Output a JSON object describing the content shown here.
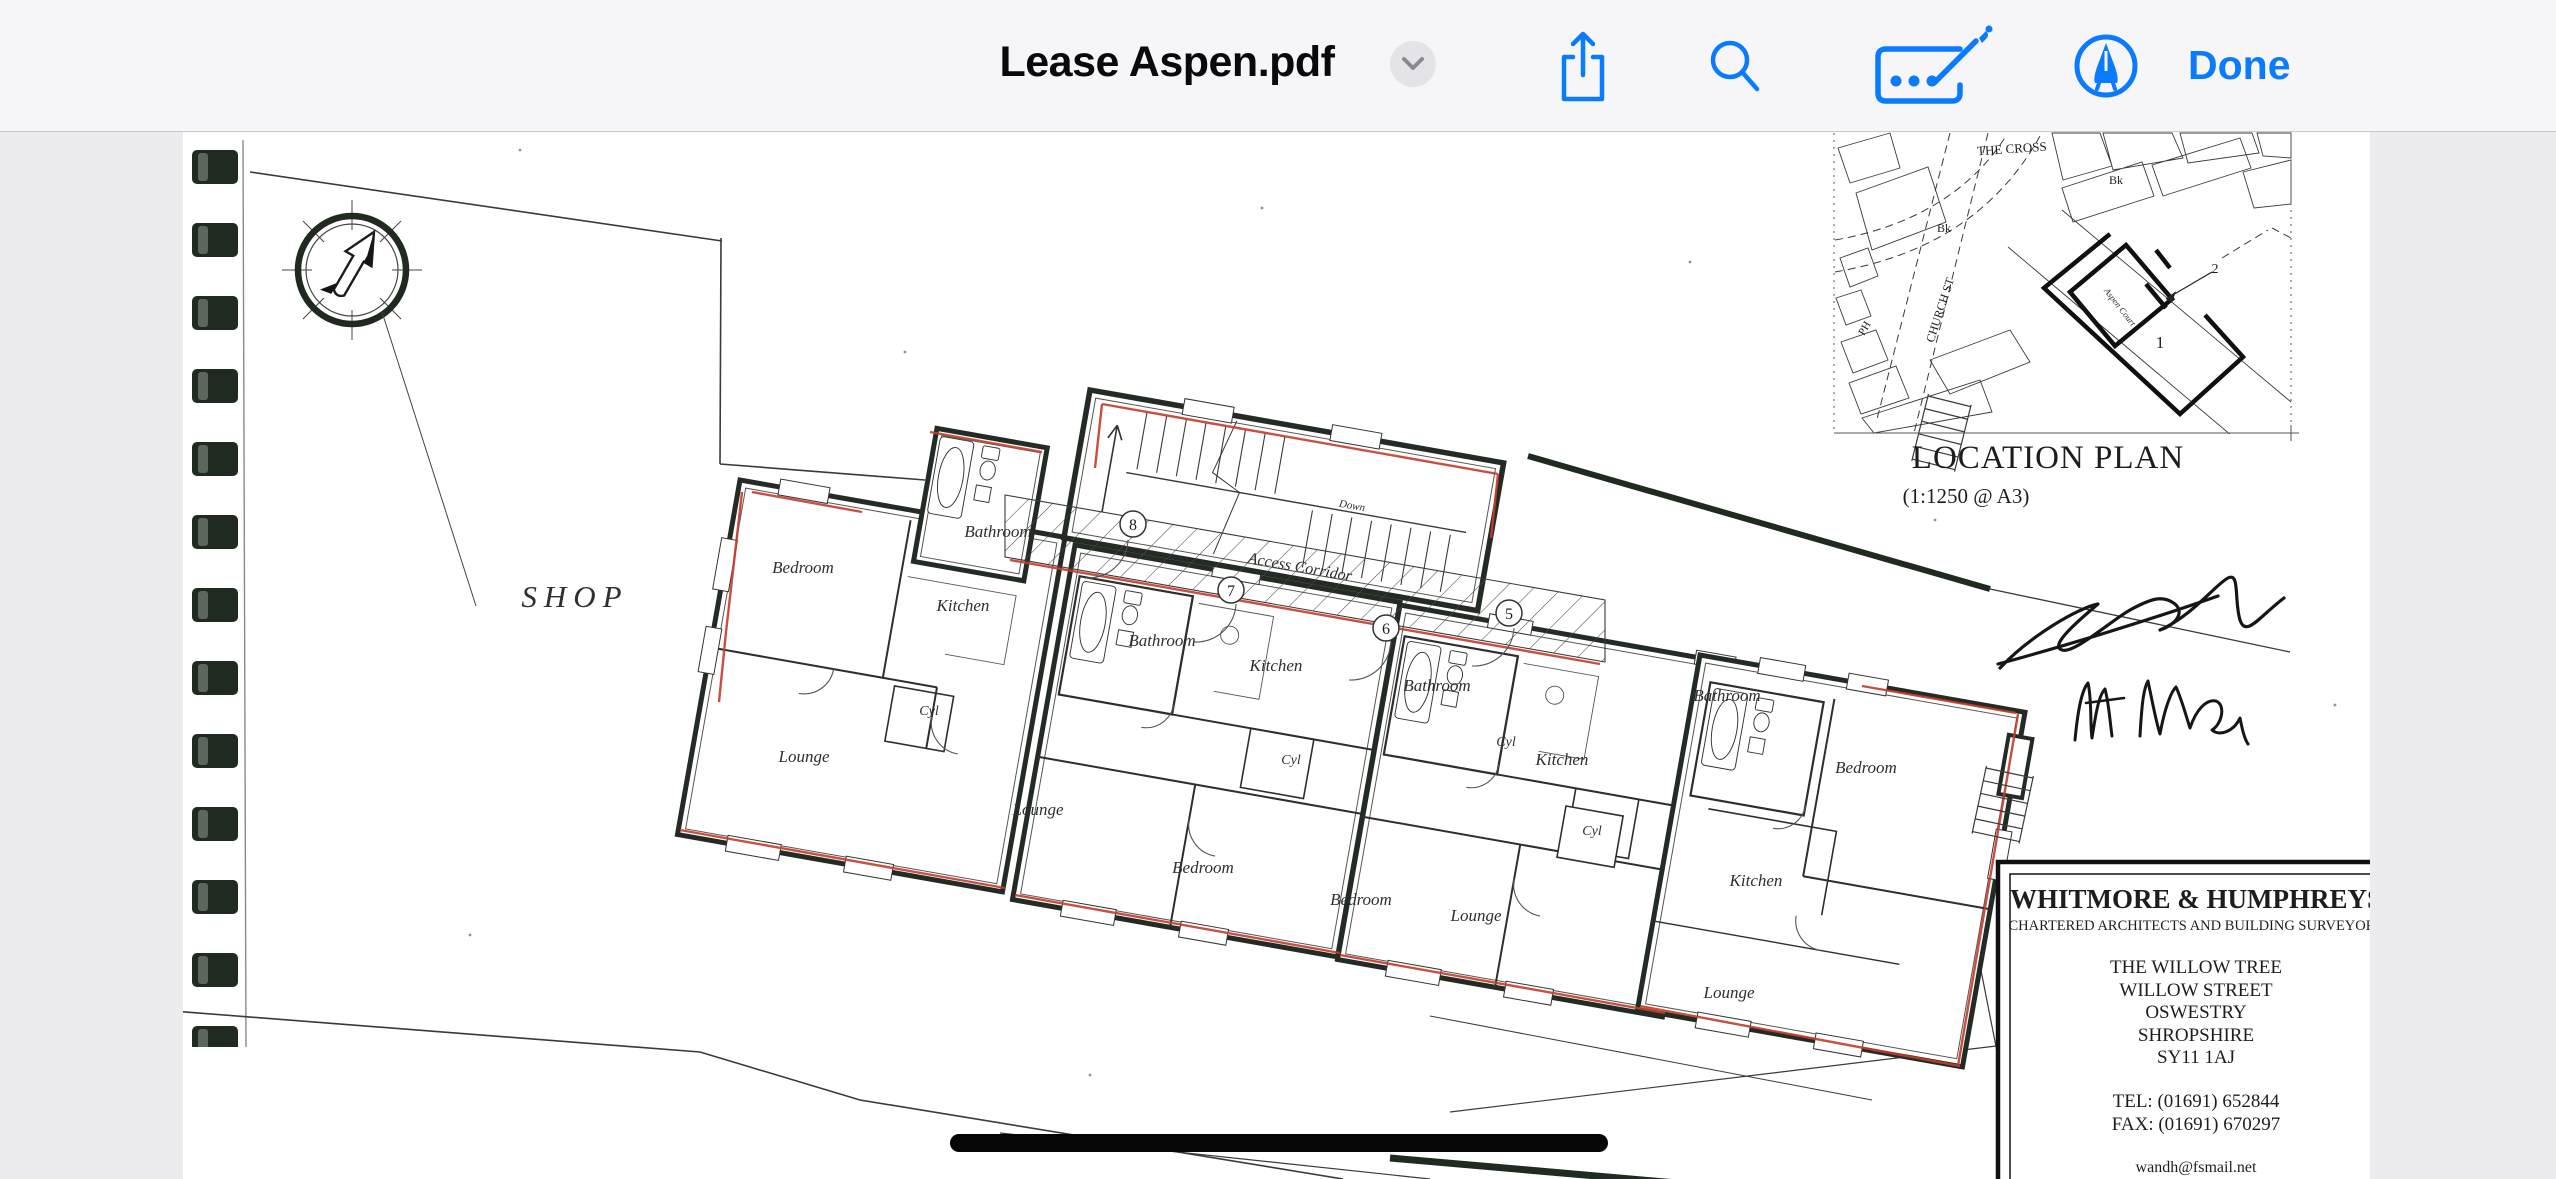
{
  "toolbar": {
    "title": "Lease Aspen.pdf",
    "done_label": "Done",
    "icons": [
      "chevron-down-icon",
      "share-icon",
      "search-icon",
      "autofill-signature-icon",
      "markup-pen-icon"
    ]
  },
  "colors": {
    "accent": "#0a7aff",
    "toolbar_bg": "#f6f6f8",
    "margin_bg": "#ececee",
    "page_bg": "#ffffff",
    "plan_ink": "#20291f",
    "plan_red": "#c23d2c",
    "binding_dark": "#1f2a20"
  },
  "floor_plan": {
    "shop_label": "SHOP",
    "access_corridor_label": "Access Corridor",
    "down_label": "Down",
    "rooms": [
      "Bedroom",
      "Bathroom",
      "Kitchen",
      "Cyl",
      "Lounge",
      "Bathroom",
      "Kitchen",
      "Cyl",
      "Lounge",
      "Bedroom",
      "Bathroom",
      "Cyl",
      "Kitchen",
      "Bedroom",
      "Lounge",
      "Bathroom",
      "Cyl",
      "Kitchen",
      "Bedroom",
      "Lounge"
    ],
    "unit_numbers": [
      "8",
      "7",
      "6",
      "5"
    ]
  },
  "location_plan": {
    "title": "LOCATION PLAN",
    "scale": "(1:1250 @ A3)",
    "labels": {
      "the_cross": "THE CROSS",
      "church_st": "CHURCH ST",
      "bk1": "Bk",
      "bk2": "Bk",
      "ph": "PH",
      "plot_1": "1",
      "plot_2": "2",
      "aspen_court": "Aspen Court"
    }
  },
  "title_block": {
    "firm": "WHITMORE & HUMPHREYS",
    "subtitle": "CHARTERED ARCHITECTS AND BUILDING SURVEYORS",
    "address_lines": [
      "THE WILLOW TREE",
      "WILLOW STREET",
      "OSWESTRY",
      "SHROPSHIRE",
      "SY11 1AJ"
    ],
    "tel": "TEL: (01691) 652844",
    "fax": "FAX: (01691) 670297",
    "email": "wandh@fsmail.net"
  }
}
